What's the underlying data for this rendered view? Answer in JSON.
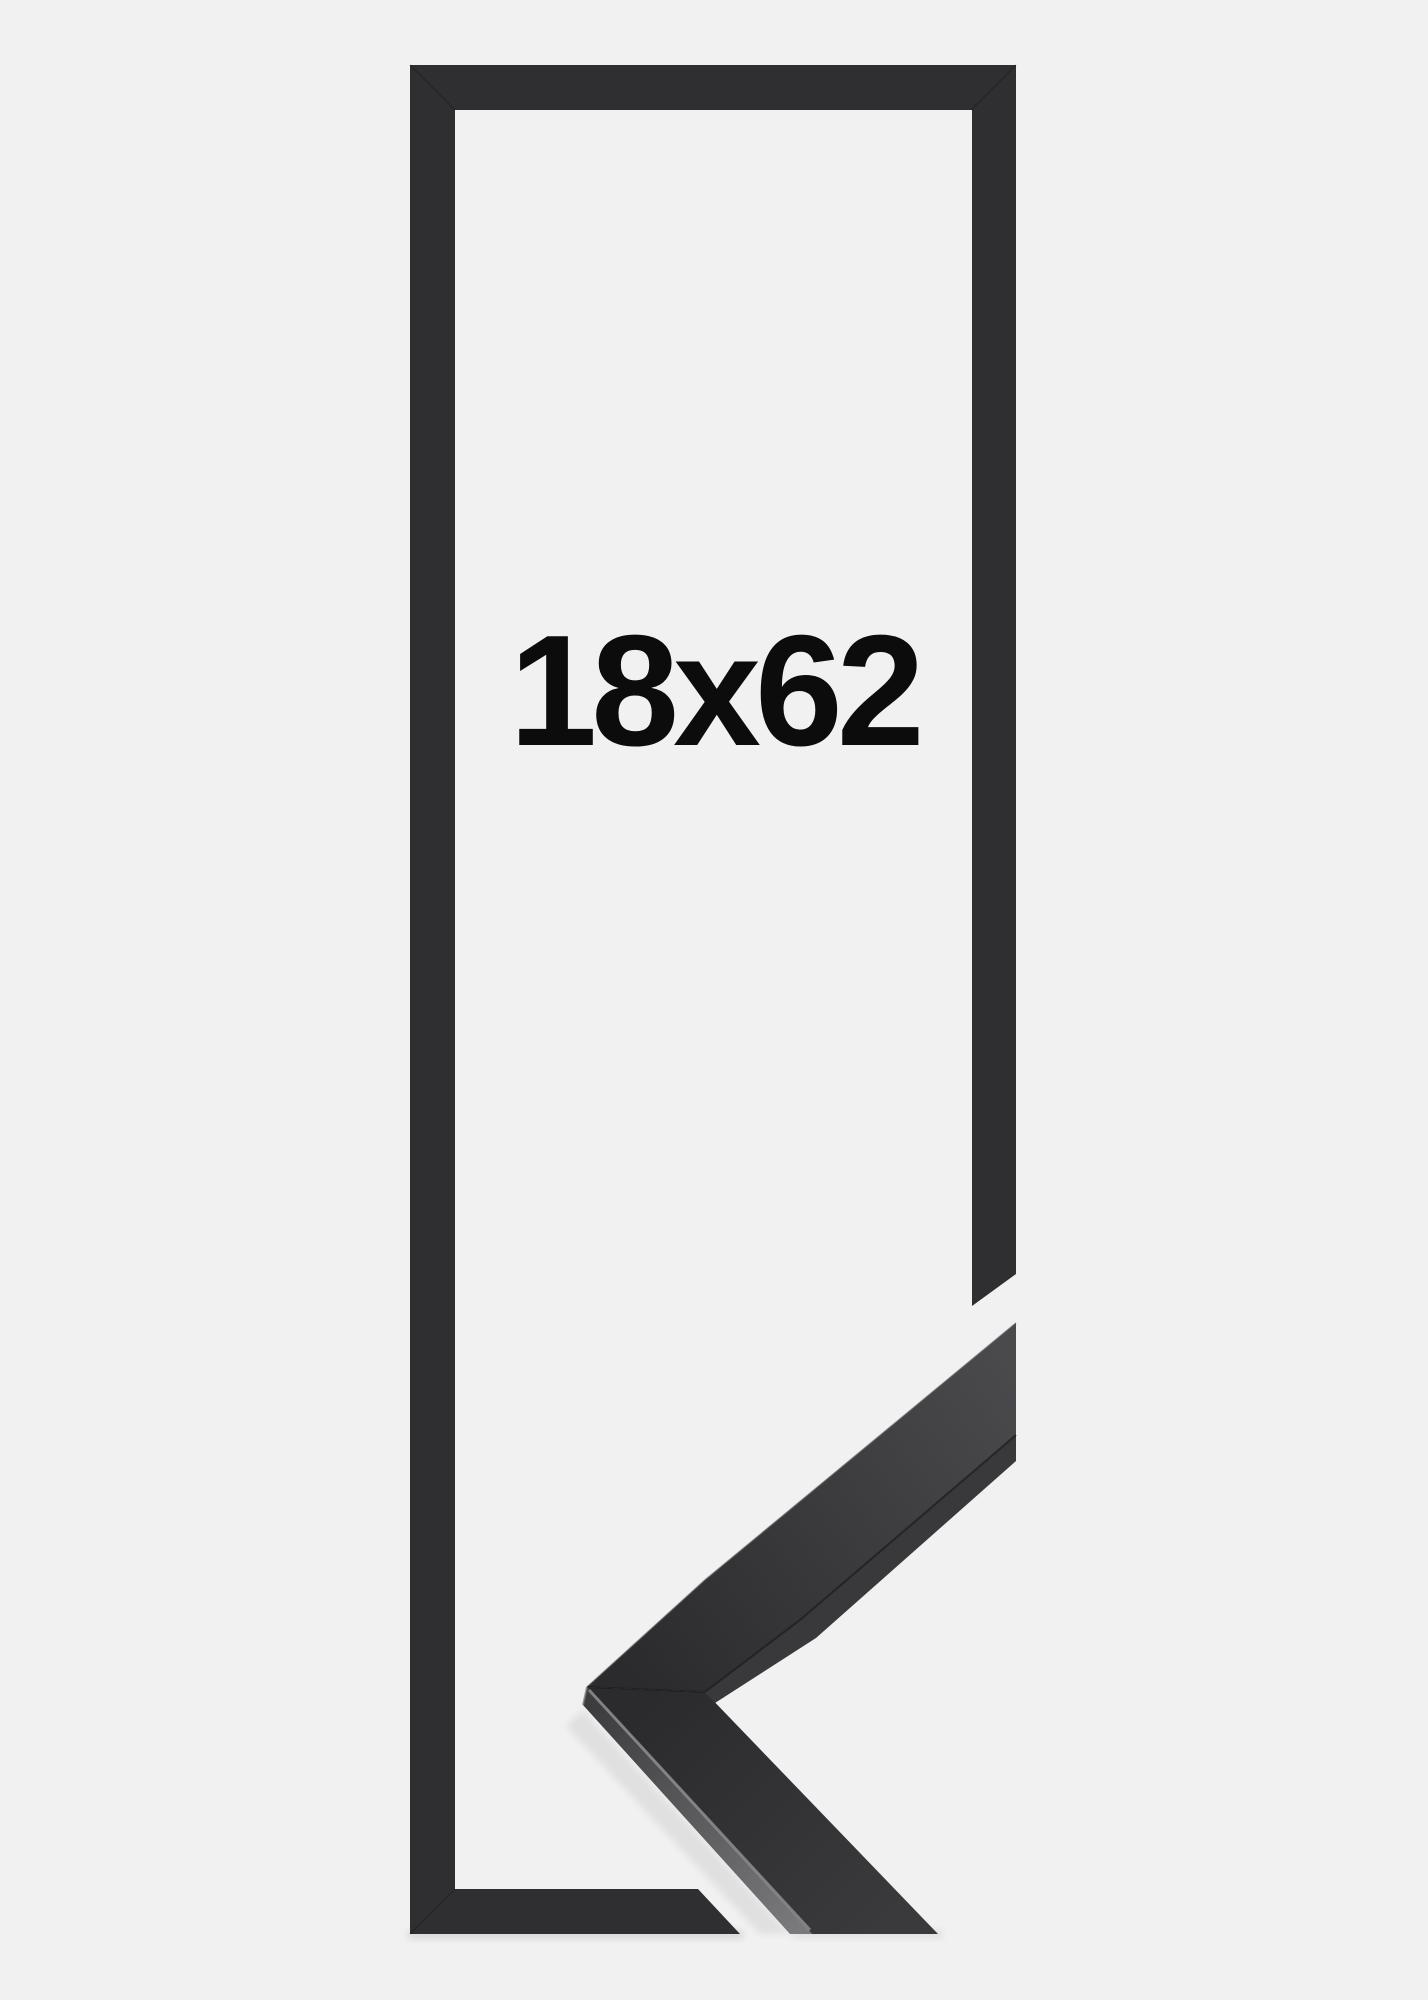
{
  "product": {
    "size_label": "18x62"
  },
  "colors": {
    "background": "#f1f1f2",
    "frame": "#2f2f31",
    "frame_seam": "#141417",
    "sample_face_dark": "#2b2b2d",
    "sample_face_tip": "#4a4a4d",
    "sample_face_bottom": "#3a3a3d",
    "sample_side_dark": "#3d3d3f",
    "sample_side_light": "#7a7a7d",
    "sample_under_edge": "#39393b",
    "sample_edge_dark_line": "#141416",
    "sample_edge_highlight": "#8e8e91",
    "sample_apex_edge": "#7a7a7d",
    "sample_rim_light": "#55555a",
    "shadow": "rgba(0,0,0,0.10)",
    "shadow_soft": "rgba(0,0,0,0.07)",
    "text": "#0c0c0c"
  }
}
